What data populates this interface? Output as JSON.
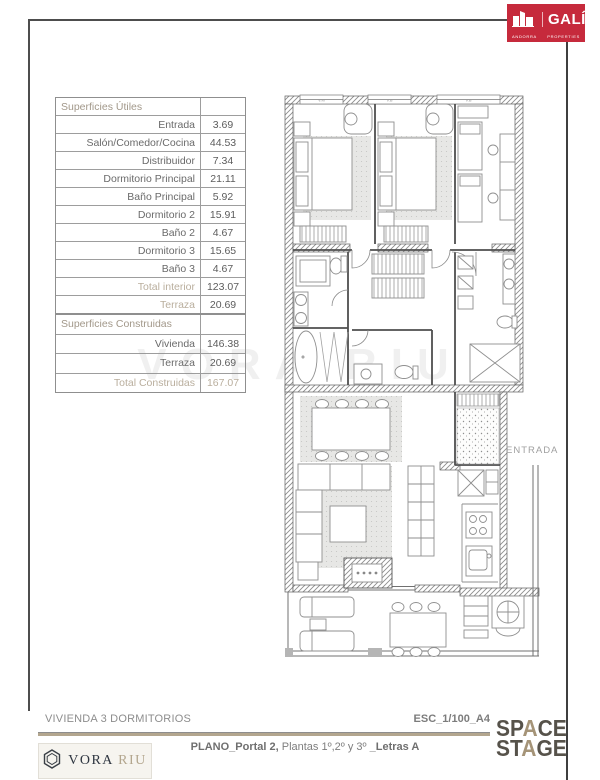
{
  "brand": {
    "gali_name": "GALÍ",
    "gali_sub1": "ANDORRA",
    "gali_sub2": "PROPERTIES",
    "gali_red": "#c62a3c"
  },
  "tables": {
    "utiles": {
      "title": "Superficies Útiles",
      "rows": [
        {
          "label": "Entrada",
          "value": "3.69"
        },
        {
          "label": "Salón/Comedor/Cocina",
          "value": "44.53"
        },
        {
          "label": "Distribuidor",
          "value": "7.34"
        },
        {
          "label": "Dormitorio Principal",
          "value": "21.11"
        },
        {
          "label": "Baño Principal",
          "value": "5.92"
        },
        {
          "label": "Dormitorio 2",
          "value": "15.91"
        },
        {
          "label": "Baño 2",
          "value": "4.67"
        },
        {
          "label": "Dormitorio 3",
          "value": "15.65"
        },
        {
          "label": "Baño 3",
          "value": "4.67"
        },
        {
          "label": "Total interior",
          "value": "123.07"
        },
        {
          "label": "Terraza",
          "value": "20.69"
        }
      ]
    },
    "construidas": {
      "title": "Superficies Construidas",
      "rows": [
        {
          "label": "Vivienda",
          "value": "146.38"
        },
        {
          "label": "Terraza",
          "value": "20.69"
        },
        {
          "label": "Total Construidas",
          "value": "167.07"
        }
      ]
    }
  },
  "plan": {
    "entrada": "ENTRADA",
    "windows": [
      "V.M",
      "V.B",
      "V.B"
    ]
  },
  "watermark": "VORA RIU",
  "footer": {
    "dwelling": "VIVIENDA 3 DORMITORIOS",
    "scale": "ESC_1/100_A4",
    "plano_b1": "PLANO_Portal 2,",
    "plano_r": " Plantas 1º,2º y 3º ",
    "plano_b2": "_Letras A",
    "vora_w1": "VORA",
    "vora_w2": "RIU",
    "stage": {
      "l1a": "SP",
      "l1b": "A",
      "l1c": "CE",
      "l2a": "ST",
      "l2b": "A",
      "l2c": "GE"
    },
    "rule_tan": "#b3a68e",
    "stage_accent": "#a59478"
  }
}
